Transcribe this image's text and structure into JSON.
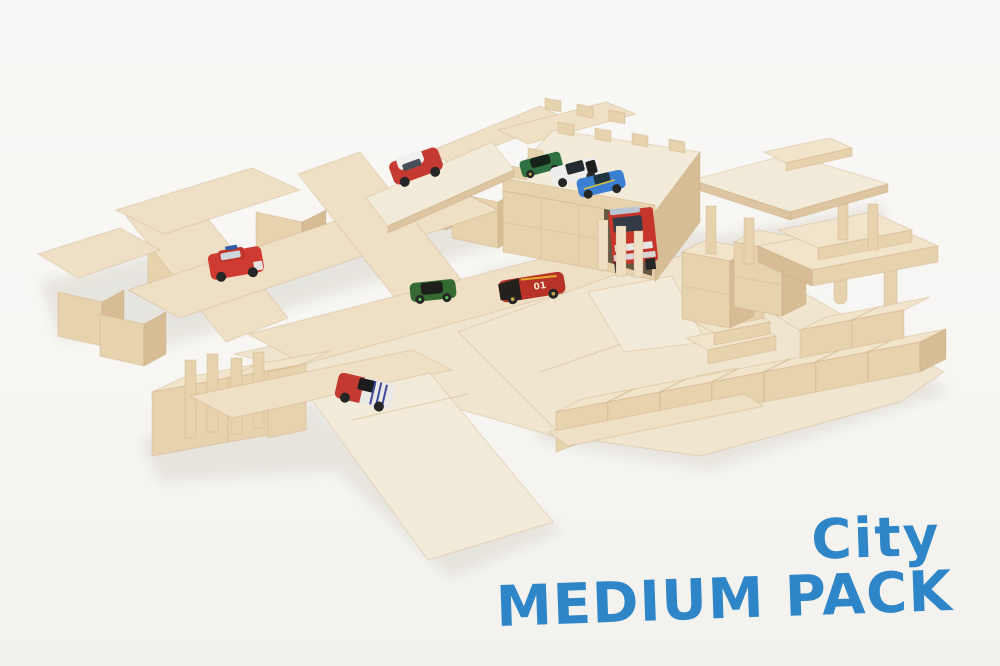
{
  "scene": {
    "type": "product-photo",
    "subject": "Wooden toy city building-block set with plywood roads, ramps, a block garage and die-cast toy cars on a white studio background"
  },
  "caption": {
    "line1": "City",
    "line2": "MEDIUM PACK",
    "color": "#2e86c8"
  },
  "palette": {
    "background": "#f7f6f3",
    "plywood_light": "#f3ebd9",
    "plywood_mid": "#eedfc5",
    "block_face": "#e7d2ae",
    "block_side": "#d7bd96",
    "block_top": "#f1e4ca",
    "shadow": "#e3e0d9",
    "garage_interior": "#675844"
  },
  "vehicles": [
    {
      "name": "red-mini-white-roof",
      "color": "#c43a30"
    },
    {
      "name": "red-suv",
      "color": "#cf3b30"
    },
    {
      "name": "green-sports-car",
      "color": "#356b33"
    },
    {
      "name": "red-race-car",
      "color": "#b83227",
      "label": "01"
    },
    {
      "name": "red-white-striped-car",
      "color": "#c23a30"
    },
    {
      "name": "green-roof-car",
      "color": "#2f7040"
    },
    {
      "name": "white-roof-car",
      "color": "#edeeec"
    },
    {
      "name": "blue-roof-car",
      "color": "#3a7fd2"
    },
    {
      "name": "red-truck-in-garage",
      "color": "#c6362b"
    }
  ]
}
